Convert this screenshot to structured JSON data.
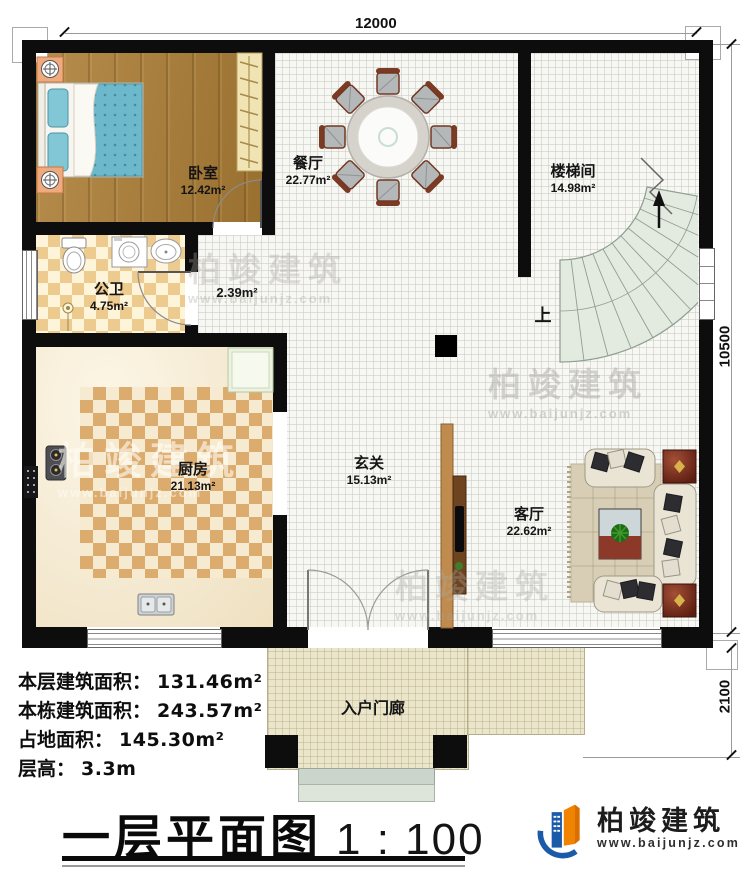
{
  "dims": {
    "width": "12000",
    "height_upper": "10500",
    "height_lower": "2100"
  },
  "rooms": [
    {
      "name": "卧室",
      "area": "12.42m²"
    },
    {
      "name": "餐厅",
      "area": "22.77m²"
    },
    {
      "name": "楼梯间",
      "area": "14.98m²"
    },
    {
      "name": "公卫",
      "area": "4.75m²"
    },
    {
      "name": "",
      "area": "2.39m²"
    },
    {
      "name": "厨房",
      "area": "21.13m²"
    },
    {
      "name": "玄关",
      "area": "15.13m²"
    },
    {
      "name": "客厅",
      "area": "22.62m²"
    },
    {
      "name": "入户门廊",
      "area": ""
    }
  ],
  "stairs": {
    "up": "上"
  },
  "info": [
    {
      "label": "本层建筑面积：",
      "value": "131.46m²"
    },
    {
      "label": "本栋建筑面积：",
      "value": "243.57m²"
    },
    {
      "label": "占地面积：",
      "value": "145.30m²"
    },
    {
      "label": "层高：",
      "value": "3.3m"
    }
  ],
  "title": {
    "main": "一层平面图",
    "scale": "1 : 100"
  },
  "brand": {
    "name": "柏竣建筑",
    "url": "www.baijunjz.com"
  },
  "watermark": {
    "name": "柏竣建筑",
    "url": "www.baijunjz.com"
  },
  "colors": {
    "wall": "#0d0d0d",
    "checker": "#edca8d",
    "wood": "#a57c3c",
    "stair_tread": "#e3eae0",
    "tile": "#f7f7f4",
    "brand_blue": "#1b5aa8",
    "brand_orange": "#f08300"
  }
}
